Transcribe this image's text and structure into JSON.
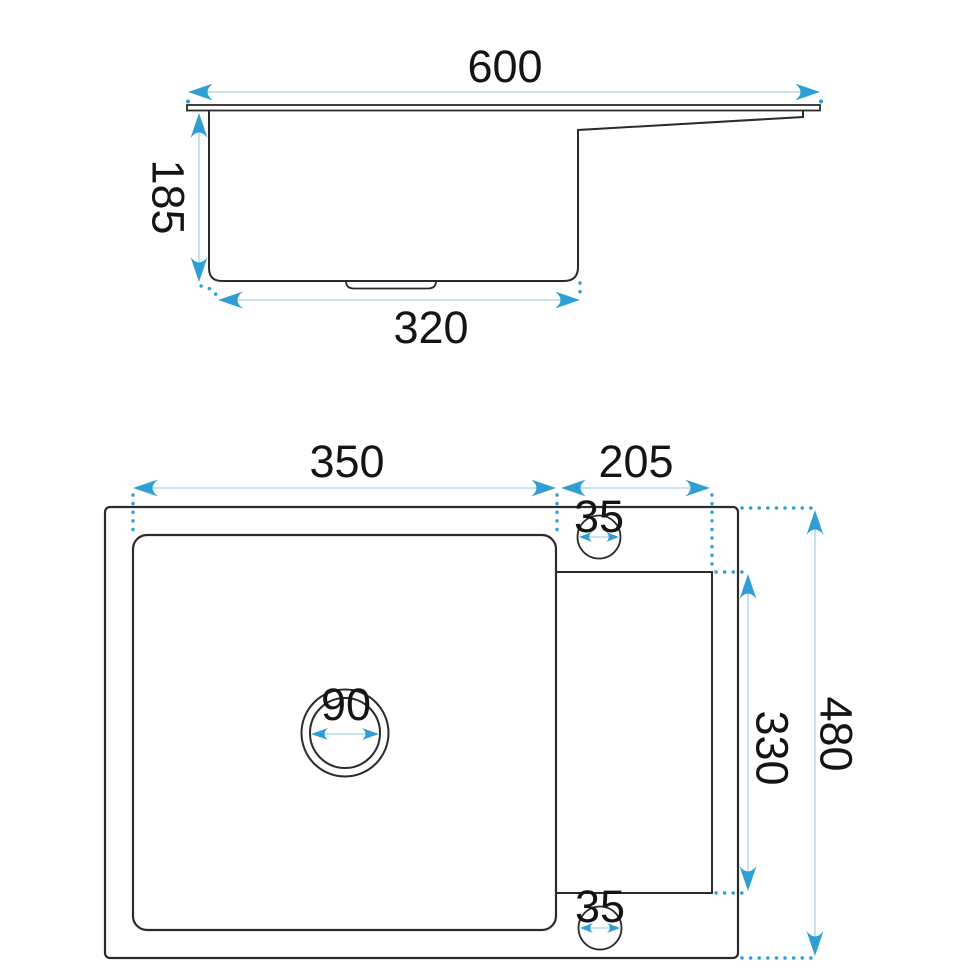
{
  "page": {
    "background": "#ffffff"
  },
  "drawing": {
    "subject": "Kitchen sink with drainer - dimensioned technical drawing, side profile and top plan views",
    "colors": {
      "outline": "#2b2b2b",
      "dimension_accent": "#2e9ed5",
      "dimension_line": "#a9d2e5"
    },
    "side_view": {
      "overall_width": "600",
      "bowl_depth": "185",
      "bowl_bottom_width": "320"
    },
    "plan_view": {
      "bowl_width": "350",
      "drainer_width": "205",
      "top_hole_diameter": "35",
      "drain_diameter": "90",
      "drainer_length": "330",
      "bottom_hole_diameter": "35",
      "overall_length": "480"
    }
  }
}
